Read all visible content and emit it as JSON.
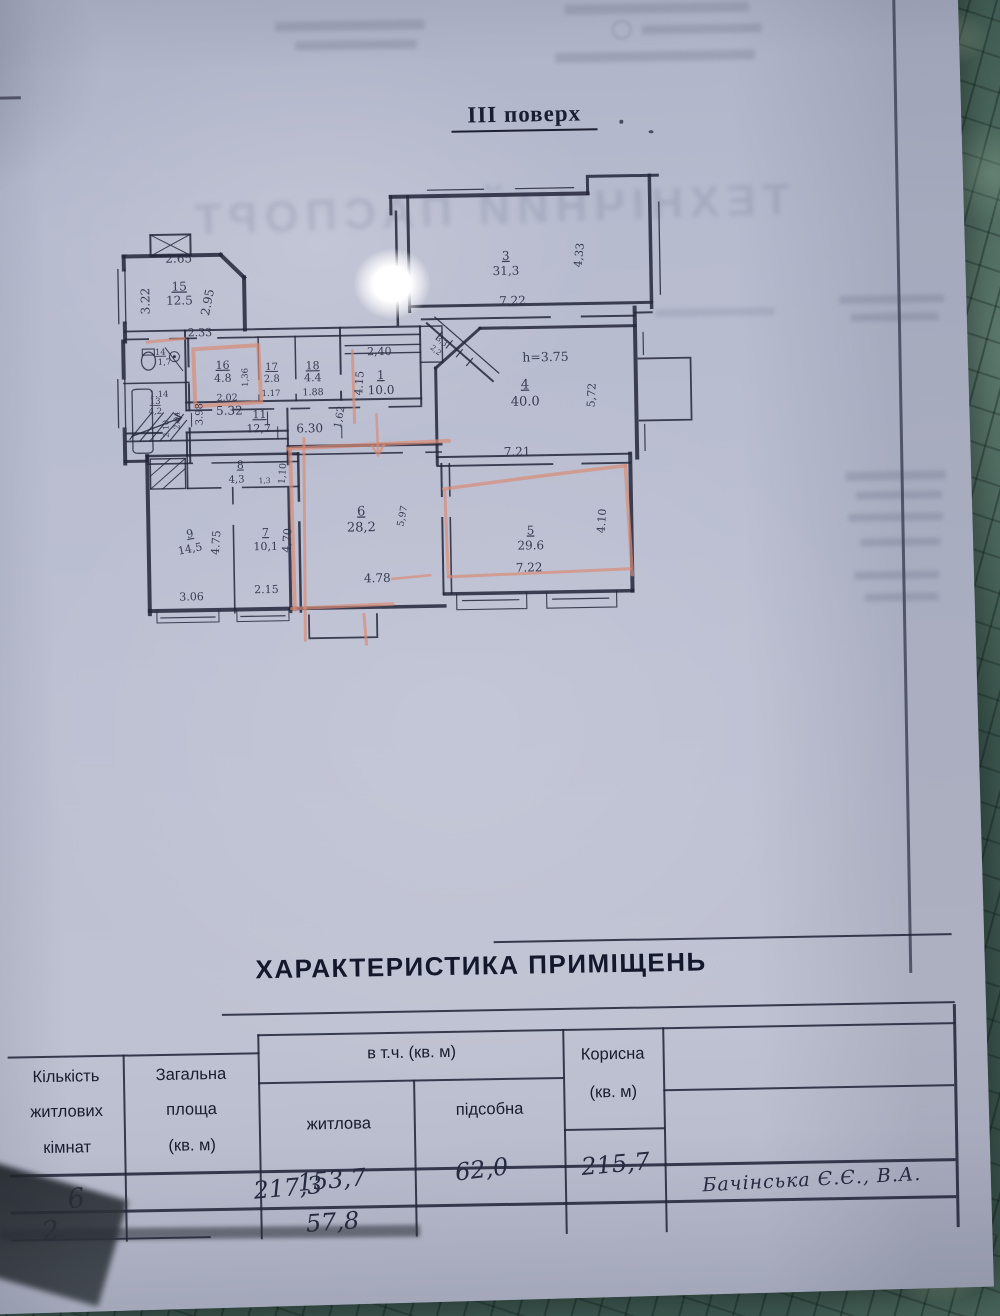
{
  "document": {
    "floor_title": "III поверх",
    "ghost_cover_title": "ТЕХНІЧНИЙ ПАСПОРТ"
  },
  "plan": {
    "labels": [
      {
        "t": "2.65",
        "x": 90,
        "y": 92,
        "s": 12
      },
      {
        "t": "3.22",
        "x": 60,
        "y": 130,
        "s": 12,
        "r": -90
      },
      {
        "t": "15",
        "x": 90,
        "y": 120,
        "s": 12,
        "u": 1
      },
      {
        "t": "12.5",
        "x": 90,
        "y": 134,
        "s": 12
      },
      {
        "t": "2.95",
        "x": 122,
        "y": 133,
        "s": 12,
        "r": -78
      },
      {
        "t": "2.33",
        "x": 110,
        "y": 166,
        "s": 11
      },
      {
        "t": "14",
        "x": 70,
        "y": 184,
        "s": 8.5,
        "u": 1
      },
      {
        "t": "1,7",
        "x": 74,
        "y": 194,
        "s": 8.5
      },
      {
        "t": "1.14",
        "x": 68,
        "y": 226,
        "s": 8.5
      },
      {
        "t": "13",
        "x": 64,
        "y": 233,
        "s": 8.5,
        "u": 1
      },
      {
        "t": "4,2",
        "x": 64,
        "y": 243,
        "s": 8.5
      },
      {
        "t": "2.10",
        "x": 77,
        "y": 258,
        "s": 8,
        "r": -90
      },
      {
        "t": "2.94",
        "x": 88,
        "y": 250,
        "s": 8,
        "r": -90
      },
      {
        "t": "3.98",
        "x": 111,
        "y": 244,
        "s": 10,
        "r": -90
      },
      {
        "t": "16",
        "x": 132,
        "y": 199,
        "s": 11,
        "u": 1
      },
      {
        "t": "4.8",
        "x": 132,
        "y": 212,
        "s": 11
      },
      {
        "t": "2.02",
        "x": 136,
        "y": 231,
        "s": 9.5
      },
      {
        "t": "1,36",
        "x": 157,
        "y": 208,
        "s": 8.5,
        "r": -90
      },
      {
        "t": "17",
        "x": 181,
        "y": 201,
        "s": 10,
        "u": 1
      },
      {
        "t": "2.8",
        "x": 181,
        "y": 213,
        "s": 10
      },
      {
        "t": "1.17",
        "x": 180,
        "y": 227,
        "s": 8.5
      },
      {
        "t": "18",
        "x": 222,
        "y": 201,
        "s": 11,
        "u": 1
      },
      {
        "t": "4.4",
        "x": 222,
        "y": 213,
        "s": 11
      },
      {
        "t": "1.88",
        "x": 222,
        "y": 227,
        "s": 9.5
      },
      {
        "t": "1",
        "x": 290,
        "y": 212,
        "s": 12,
        "u": 1
      },
      {
        "t": "10.0",
        "x": 290,
        "y": 227,
        "s": 12
      },
      {
        "t": "2,40",
        "x": 289,
        "y": 188,
        "s": 11
      },
      {
        "t": "4.15",
        "x": 272,
        "y": 216,
        "s": 11,
        "r": -85
      },
      {
        "t": "3,3",
        "x": 350,
        "y": 177,
        "s": 7.5,
        "r": 40
      },
      {
        "t": "2,2",
        "x": 344,
        "y": 186,
        "s": 7.5,
        "r": 40
      },
      {
        "t": "5.32",
        "x": 138,
        "y": 245,
        "s": 12
      },
      {
        "t": "11",
        "x": 168,
        "y": 249,
        "s": 11,
        "u": 1
      },
      {
        "t": "12,7",
        "x": 167,
        "y": 263,
        "s": 11
      },
      {
        "t": "6.30",
        "x": 218,
        "y": 264,
        "s": 12
      },
      {
        "t": "1,62",
        "x": 251,
        "y": 250,
        "s": 10,
        "r": -78
      },
      {
        "t": "3",
        "x": 417,
        "y": 95,
        "s": 12,
        "u": 1
      },
      {
        "t": "31,3",
        "x": 417,
        "y": 110,
        "s": 12
      },
      {
        "t": "7.22",
        "x": 423,
        "y": 140,
        "s": 12
      },
      {
        "t": "4,33",
        "x": 494,
        "y": 92,
        "s": 11,
        "r": -83
      },
      {
        "t": "h=3.75",
        "x": 455,
        "y": 197,
        "s": 12.5
      },
      {
        "t": "4",
        "x": 434,
        "y": 224,
        "s": 13,
        "u": 1
      },
      {
        "t": "40.0",
        "x": 434,
        "y": 241,
        "s": 13
      },
      {
        "t": "7.21",
        "x": 425,
        "y": 291,
        "s": 12
      },
      {
        "t": "5,72",
        "x": 504,
        "y": 232,
        "s": 11,
        "r": -86
      },
      {
        "t": "5",
        "x": 437,
        "y": 370,
        "s": 12,
        "u": 1
      },
      {
        "t": "29.6",
        "x": 437,
        "y": 385,
        "s": 12
      },
      {
        "t": "7.22",
        "x": 435,
        "y": 407,
        "s": 12
      },
      {
        "t": "4.10",
        "x": 512,
        "y": 358,
        "s": 11,
        "r": -85
      },
      {
        "t": "6",
        "x": 268,
        "y": 348,
        "s": 13,
        "u": 1
      },
      {
        "t": "28,2",
        "x": 268,
        "y": 364,
        "s": 13
      },
      {
        "t": "4.78",
        "x": 283,
        "y": 415,
        "s": 12
      },
      {
        "t": "5,97",
        "x": 312,
        "y": 350,
        "s": 9.5,
        "r": -78
      },
      {
        "t": "1,10",
        "x": 193,
        "y": 305,
        "s": 9.5,
        "r": -85
      },
      {
        "t": "8",
        "x": 148,
        "y": 299,
        "s": 11,
        "u": 1
      },
      {
        "t": "4,3",
        "x": 144,
        "y": 313,
        "s": 10
      },
      {
        "t": "1,3",
        "x": 172,
        "y": 314,
        "s": 7.5
      },
      {
        "t": "9",
        "x": 97,
        "y": 367,
        "s": 11,
        "u": 1,
        "r": -10
      },
      {
        "t": "14,5",
        "x": 97,
        "y": 382,
        "s": 11,
        "r": -10
      },
      {
        "t": "4.75",
        "x": 126,
        "y": 373,
        "s": 11,
        "r": -85
      },
      {
        "t": "3.06",
        "x": 97,
        "y": 430,
        "s": 11
      },
      {
        "t": "7",
        "x": 172,
        "y": 367,
        "s": 11,
        "u": 1
      },
      {
        "t": "10,1",
        "x": 172,
        "y": 381,
        "s": 11
      },
      {
        "t": "4,70",
        "x": 197,
        "y": 372,
        "s": 11,
        "r": -85
      },
      {
        "t": "2.15",
        "x": 172,
        "y": 424,
        "s": 11
      }
    ]
  },
  "table": {
    "title": "ХАРАКТЕРИСТИКА ПРИМІЩЕНЬ",
    "headers": {
      "rooms": "Кількість\nжитлових\nкімнат",
      "total": "Загальна\nплоща\n(кв. м)",
      "including": "в т.ч. (кв. м)",
      "living": "житлова",
      "auxiliary": "підсобна",
      "useful": "Корисна\n(кв. м)"
    },
    "rows": [
      {
        "rooms": "6",
        "total": "217,3",
        "living": "153,7",
        "auxiliary": "62,0",
        "useful": "215,7",
        "note": "Бачінська Є.Є., В.А."
      },
      {
        "rooms": "2",
        "total": "",
        "living": "57,8",
        "auxiliary": "",
        "useful": "",
        "note": ""
      }
    ]
  }
}
